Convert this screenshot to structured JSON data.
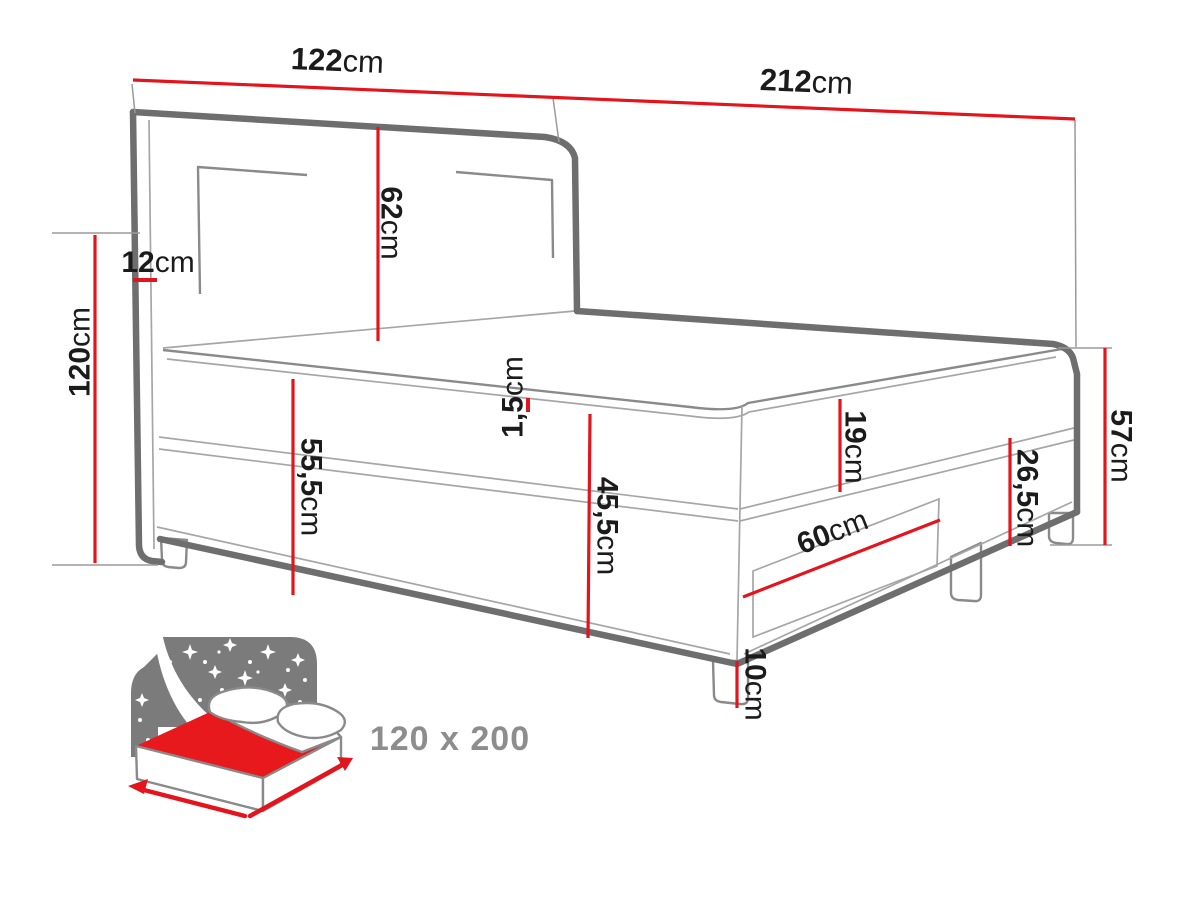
{
  "diagram": {
    "type": "bed-dimension-diagram",
    "unit": "cm",
    "dims": {
      "headboard_width": {
        "value": "122",
        "unit": "cm"
      },
      "total_length": {
        "value": "212",
        "unit": "cm"
      },
      "headboard_height": {
        "value": "120",
        "unit": "cm"
      },
      "headboard_depth": {
        "value": "12",
        "unit": "cm"
      },
      "headboard_above_mattress": {
        "value": "62",
        "unit": "cm"
      },
      "topper_seam": {
        "value": "1,5",
        "unit": "cm"
      },
      "height_without_legs": {
        "value": "55,5",
        "unit": "cm"
      },
      "base_with_mattress": {
        "value": "45,5",
        "unit": "cm"
      },
      "mattress_height": {
        "value": "19",
        "unit": "cm"
      },
      "base_box_height": {
        "value": "26,5",
        "unit": "cm"
      },
      "side_height_total": {
        "value": "57",
        "unit": "cm"
      },
      "drawer_width": {
        "value": "60",
        "unit": "cm"
      },
      "leg_height": {
        "value": "10",
        "unit": "cm"
      }
    },
    "size_badge": {
      "value": "120 x 200"
    },
    "colors": {
      "dimension_red": "#e3141c",
      "outline_gray": "#6e6e6e",
      "icon_gray": "#7b7b7b",
      "mattress_red": "#e8191c",
      "badge_gray": "#8d8d8d"
    }
  }
}
